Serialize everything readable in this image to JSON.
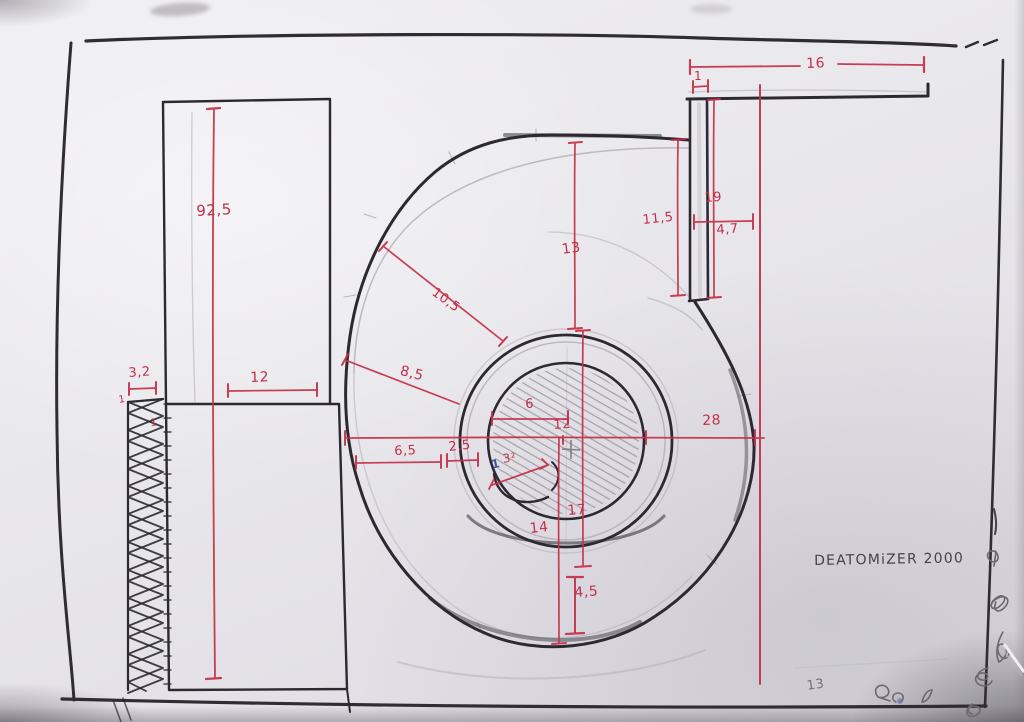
{
  "sheet": {
    "title": "DEATOMiZER 2000",
    "corner_note": "13"
  },
  "dims": {
    "left_height": "92,5",
    "hatch_width": "3,2",
    "hatch_wall_a": "1",
    "hatch_wall_b": "1",
    "lower_rect_width": "12",
    "outlet_length": "16",
    "outlet_gap": "1",
    "outlet_depth_right": "19",
    "outlet_depth_left": "11,5",
    "outlet_width": "4,7",
    "top_radius": "13",
    "radius_upper": "10,5",
    "radius_left": "8,5",
    "hub_width": "6",
    "center_width": "12",
    "right_offset": "28",
    "left_offset": "6,5",
    "ring_gap": "2,5",
    "hub_detail_blue": "1",
    "hub_detail_red": "3²",
    "radius_lower_right": "17",
    "radius_lower": "14",
    "shell_gap": "4,5"
  },
  "colors": {
    "dimension_red": "#c52f48",
    "pencil_dark": "#2c2a30",
    "pencil_grey": "#9a97a0",
    "note_blue": "#3d52a8"
  }
}
